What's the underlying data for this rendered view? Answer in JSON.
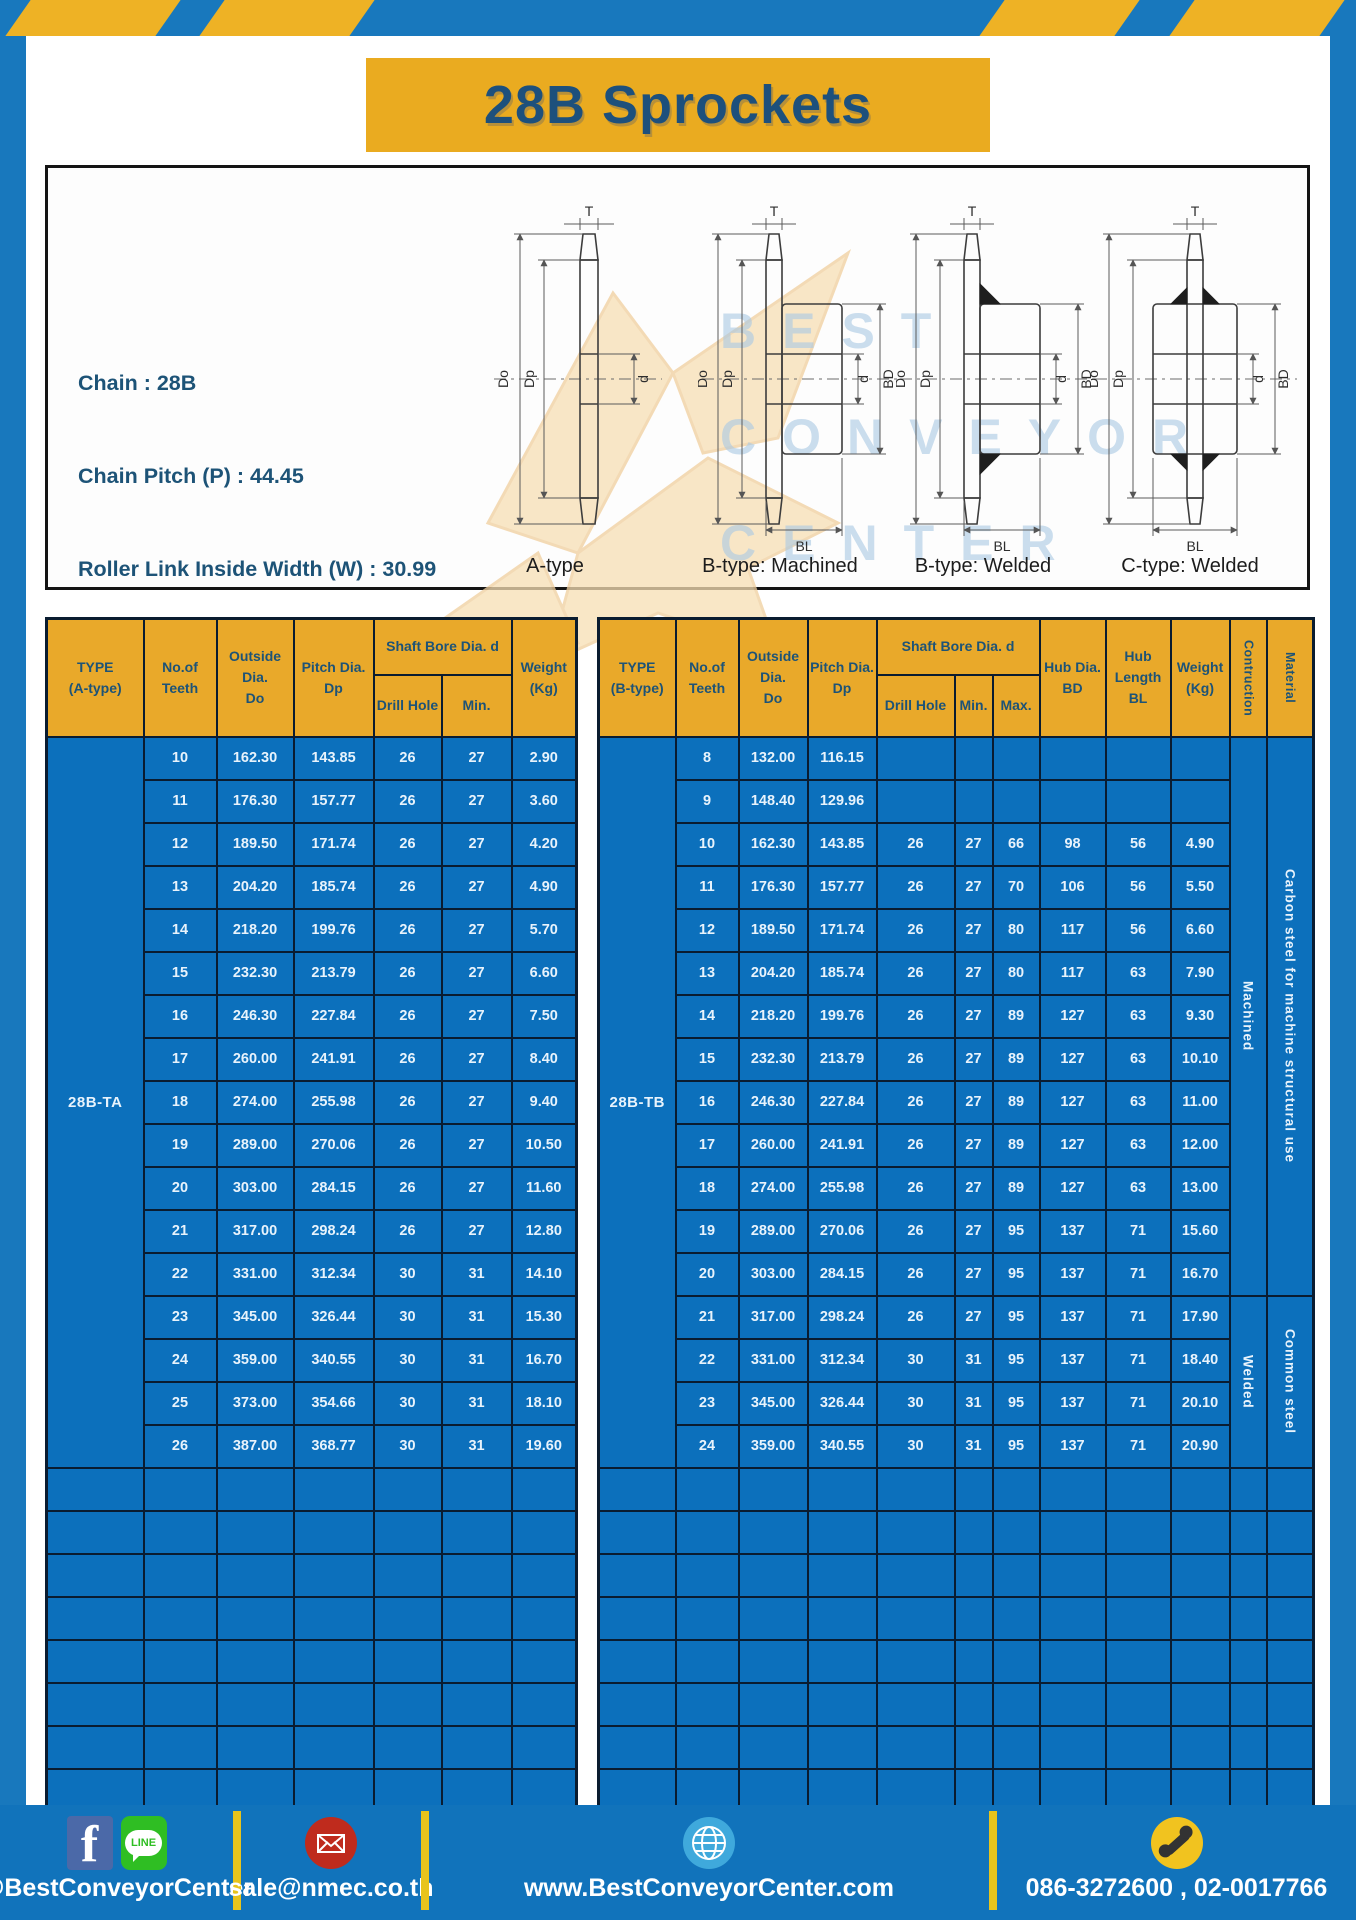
{
  "page": {
    "title": "28B Sprockets"
  },
  "colors": {
    "frame_blue": "#1878bd",
    "stripe_yellow": "#eeb225",
    "header_gold": "#e9a92a",
    "table_blue": "#0c70bc",
    "navy_text": "#1d5377",
    "footer_blue": "#1173bb",
    "divider_yellow": "#e8c41c"
  },
  "diagram": {
    "specs": [
      "Chain : 28B",
      "Chain Pitch (P) : 44.45",
      "Roller Link Inside Width (W) : 30.99",
      "Roller Diameter (Dr) : 27.94",
      "Teeth Width (T) : 29.4"
    ],
    "captions": [
      "A-type",
      "B-type: Machined",
      "B-type: Welded",
      "C-type: Welded"
    ],
    "dim_labels": {
      "t": "T",
      "outside": "Do",
      "pitch": "Dp",
      "bore": "d",
      "hub_dia": "BD",
      "hub_len": "BL"
    },
    "watermark": [
      "BEST",
      "CONVEYOR",
      "CENTER"
    ]
  },
  "table_a": {
    "headers": {
      "type": "TYPE\n(A-type)",
      "teeth": "No.of\nTeeth",
      "outside": "Outside\nDia.\nDo",
      "pitch": "Pitch Dia.\nDp",
      "shaft_bore": "Shaft Bore Dia. d",
      "drill_hole": "Drill Hole",
      "min": "Min.",
      "weight": "Weight\n(Kg)"
    },
    "type_label": "28B-TA",
    "rows": [
      [
        "10",
        "162.30",
        "143.85",
        "26",
        "27",
        "2.90"
      ],
      [
        "11",
        "176.30",
        "157.77",
        "26",
        "27",
        "3.60"
      ],
      [
        "12",
        "189.50",
        "171.74",
        "26",
        "27",
        "4.20"
      ],
      [
        "13",
        "204.20",
        "185.74",
        "26",
        "27",
        "4.90"
      ],
      [
        "14",
        "218.20",
        "199.76",
        "26",
        "27",
        "5.70"
      ],
      [
        "15",
        "232.30",
        "213.79",
        "26",
        "27",
        "6.60"
      ],
      [
        "16",
        "246.30",
        "227.84",
        "26",
        "27",
        "7.50"
      ],
      [
        "17",
        "260.00",
        "241.91",
        "26",
        "27",
        "8.40"
      ],
      [
        "18",
        "274.00",
        "255.98",
        "26",
        "27",
        "9.40"
      ],
      [
        "19",
        "289.00",
        "270.06",
        "26",
        "27",
        "10.50"
      ],
      [
        "20",
        "303.00",
        "284.15",
        "26",
        "27",
        "11.60"
      ],
      [
        "21",
        "317.00",
        "298.24",
        "26",
        "27",
        "12.80"
      ],
      [
        "22",
        "331.00",
        "312.34",
        "30",
        "31",
        "14.10"
      ],
      [
        "23",
        "345.00",
        "326.44",
        "30",
        "31",
        "15.30"
      ],
      [
        "24",
        "359.00",
        "340.55",
        "30",
        "31",
        "16.70"
      ],
      [
        "25",
        "373.00",
        "354.66",
        "30",
        "31",
        "18.10"
      ],
      [
        "26",
        "387.00",
        "368.77",
        "30",
        "31",
        "19.60"
      ]
    ],
    "empty_rows": 8
  },
  "table_b": {
    "headers": {
      "type": "TYPE\n(B-type)",
      "teeth": "No.of\nTeeth",
      "outside": "Outside\nDia.\nDo",
      "pitch": "Pitch Dia.\nDp",
      "shaft_bore": "Shaft Bore Dia. d",
      "drill_hole": "Drill Hole",
      "min": "Min.",
      "max": "Max.",
      "hub_dia": "Hub Dia.\nBD",
      "hub_length": "Hub\nLength\nBL",
      "weight": "Weight\n(Kg)",
      "construction": "Contruction",
      "material": "Material"
    },
    "type_label": "28B-TB",
    "rows": [
      [
        "8",
        "132.00",
        "116.15",
        "",
        "",
        "",
        "",
        "",
        ""
      ],
      [
        "9",
        "148.40",
        "129.96",
        "",
        "",
        "",
        "",
        "",
        ""
      ],
      [
        "10",
        "162.30",
        "143.85",
        "26",
        "27",
        "66",
        "98",
        "56",
        "4.90"
      ],
      [
        "11",
        "176.30",
        "157.77",
        "26",
        "27",
        "70",
        "106",
        "56",
        "5.50"
      ],
      [
        "12",
        "189.50",
        "171.74",
        "26",
        "27",
        "80",
        "117",
        "56",
        "6.60"
      ],
      [
        "13",
        "204.20",
        "185.74",
        "26",
        "27",
        "80",
        "117",
        "63",
        "7.90"
      ],
      [
        "14",
        "218.20",
        "199.76",
        "26",
        "27",
        "89",
        "127",
        "63",
        "9.30"
      ],
      [
        "15",
        "232.30",
        "213.79",
        "26",
        "27",
        "89",
        "127",
        "63",
        "10.10"
      ],
      [
        "16",
        "246.30",
        "227.84",
        "26",
        "27",
        "89",
        "127",
        "63",
        "11.00"
      ],
      [
        "17",
        "260.00",
        "241.91",
        "26",
        "27",
        "89",
        "127",
        "63",
        "12.00"
      ],
      [
        "18",
        "274.00",
        "255.98",
        "26",
        "27",
        "89",
        "127",
        "63",
        "13.00"
      ],
      [
        "19",
        "289.00",
        "270.06",
        "26",
        "27",
        "95",
        "137",
        "71",
        "15.60"
      ],
      [
        "20",
        "303.00",
        "284.15",
        "26",
        "27",
        "95",
        "137",
        "71",
        "16.70"
      ],
      [
        "21",
        "317.00",
        "298.24",
        "26",
        "27",
        "95",
        "137",
        "71",
        "17.90"
      ],
      [
        "22",
        "331.00",
        "312.34",
        "30",
        "31",
        "95",
        "137",
        "71",
        "18.40"
      ],
      [
        "23",
        "345.00",
        "326.44",
        "30",
        "31",
        "95",
        "137",
        "71",
        "20.10"
      ],
      [
        "24",
        "359.00",
        "340.55",
        "30",
        "31",
        "95",
        "137",
        "71",
        "20.90"
      ]
    ],
    "sections": [
      {
        "construction": "Machined",
        "material": "Carbon steel for  machine structural use",
        "rows": 13
      },
      {
        "construction": "Welded",
        "material": "Common steel",
        "rows": 4
      }
    ],
    "empty_rows": 8
  },
  "footer": {
    "social": "@BestConveyorCenter",
    "email": "sale@nmec.co.th",
    "website": "www.BestConveyorCenter.com",
    "phone": "086-3272600 , 02-0017766",
    "facebook_glyph": "f",
    "line_label": "LINE"
  }
}
